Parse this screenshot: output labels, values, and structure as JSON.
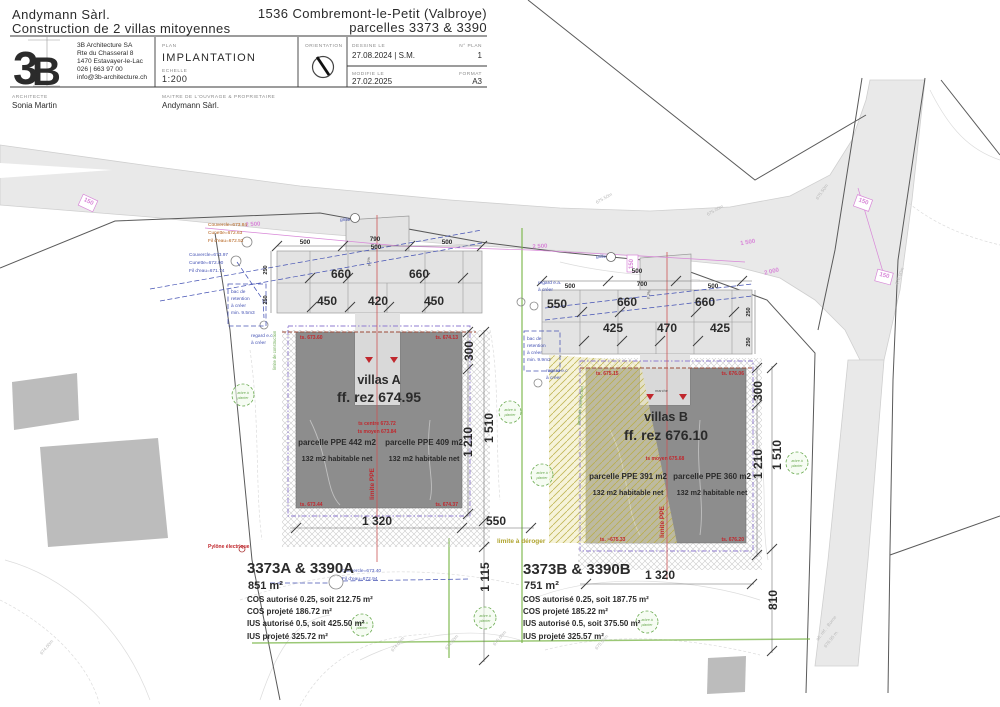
{
  "colors": {
    "ink": "#2b2b2b",
    "red": "#c0272d",
    "orange": "#b4601a",
    "blue": "#4553b4",
    "violet": "#8f7bd0",
    "green": "#6aaa50",
    "olive": "#b0a42e",
    "pink": "#d887d8",
    "roadfill": "#e9e9e9",
    "parkfill": "#e3e3e3",
    "building": "#8d8d8d",
    "existing": "#bcbcbc",
    "notch": "#d9d9d9",
    "contour": "#dcdcdc",
    "brand": "#8b2038",
    "boundary": "#5a5a5a"
  },
  "header": {
    "left_title_1": "Andymann Sàrl.",
    "left_title_2": "Construction de 2 villas mitoyennes",
    "right_title_1": "1536 Combremont-le-Petit (Valbroye)",
    "right_title_2": "parcelles 3373 & 3390",
    "logo": {
      "n": "3",
      "b": "B"
    },
    "company": [
      "3B Architecture SA",
      "Rte du Chasseral 8",
      "1470 Estavayer-le-Lac",
      "026 | 663 97 00",
      "info@3b-architecture.ch"
    ],
    "plan_label": "PLAN",
    "plan_value": "IMPLANTATION",
    "echelle_label": "ECHELLE",
    "echelle_value": "1:200",
    "orientation_label": "ORIENTATION",
    "dessine_label": "DESSINE LE",
    "dessine_value": "27.08.2024 | S.M.",
    "modifie_label": "MODIFIE LE",
    "modifie_value": "27.02.2025",
    "nplan_label": "N° PLAN",
    "nplan_value": "1",
    "format_label": "FORMAT",
    "format_value": "A3",
    "architecte_label": "ARCHITECTE",
    "architecte_value": "Sonia Martin",
    "maitre_label": "MAITRE DE L'OUVRAGE & PROPRIETAIRE",
    "maitre_value": "Andymann Sàrl."
  },
  "plan": {
    "villaA": {
      "name": "villas A",
      "ff": "ff. rez 674.95",
      "ts_centre": "ts centre 673.72",
      "ts_moyen": "ts moyen 673.84",
      "ppe_left": "parcelle PPE 442 m2",
      "ppe_right": "parcelle PPE 409 m2",
      "habitable": "132 m2 habitable net",
      "limite_ppe": "limite PPE",
      "ts_tl": "ts. 673.60",
      "ts_tr": "ts. 674.13",
      "ts_bl": "ts. 673.44",
      "ts_br": "ts. 674.37"
    },
    "villaB": {
      "name": "villas B",
      "ff": "ff. rez 676.10",
      "ts_moyen": "ts moyen 675.68",
      "ppe_left": "parcelle PPE 391 m2",
      "ppe_right": "parcelle PPE 360 m2",
      "habitable": "132 m2 habitable net",
      "limite_ppe": "limite PPE",
      "ts_tl": "ts. 675.15",
      "ts_tr": "ts. 676.06",
      "ts_bl": "ts. ~675.33",
      "ts_br": "ts. 676.20",
      "marche": "marche"
    },
    "parcelA": {
      "title": "3373A & 3390A",
      "area": "851 m²",
      "cos1": "COS autorisé 0.25, soit 212.75 m²",
      "cos2": "COS projeté 186.72 m²",
      "ius1": "IUS autorisé 0.5, soit 425.50 m²",
      "ius2": "IUS projeté 325.72 m²"
    },
    "parcelB": {
      "title": "3373B & 3390B",
      "area": "751 m²",
      "cos1": "COS autorisé 0.25, soit 187.75 m²",
      "cos2": "COS projeté 185.22 m²",
      "ius1": "IUS autorisé 0.5, soit 375.50 m²",
      "ius2": "IUS projeté 325.57 m²"
    },
    "dims": {
      "d500": "500",
      "d790": "790",
      "d700": "700",
      "d660": "660",
      "d450": "450",
      "d420": "420",
      "d425": "425",
      "d470": "470",
      "d550": "550",
      "d250": "250",
      "d300": "300",
      "d1320": "1 320",
      "d1510": "1 510",
      "d1210": "1 210",
      "d1115": "1 115",
      "d810": "810",
      "d150": "150",
      "d2500": "2 500",
      "d2000": "2 000",
      "d1500": "1 500"
    },
    "annotations": {
      "orange": [
        "Couvercle=673.84",
        "Cunette=672.63",
        "Fil d'eau=672.52"
      ],
      "blue1": [
        "Couvercle=673.97",
        "Cunette=672.00",
        "Fil d'eau=671.74"
      ],
      "blue2": [
        "Couvercle=673.40",
        "Fil d'eau=672.94"
      ],
      "bacA": [
        "bac de",
        "retention",
        "à créer",
        "min. 9.5m3"
      ],
      "bacB": [
        "bac de",
        "retention",
        "à créer",
        "min. 9.9m3"
      ],
      "regard_ec": [
        "regard e.c",
        "à créer"
      ],
      "regard_ea": [
        "regard e.a.",
        "à créer"
      ],
      "grille": "grille",
      "arbre": [
        "arbre à",
        "planter"
      ],
      "pylone": "Pylône électrique",
      "limite_deroger": "limite à déroger",
      "limite_construction": "limite de construction",
      "p2": "p 2%",
      "borne": [
        "alt. réf. : Borne",
        "676.95 m."
      ]
    },
    "contours": {
      "c674": "674.00m",
      "c6745": "674.50m",
      "c675": "675.00m",
      "c6755": "675.50m",
      "c676": "676.00m"
    }
  }
}
